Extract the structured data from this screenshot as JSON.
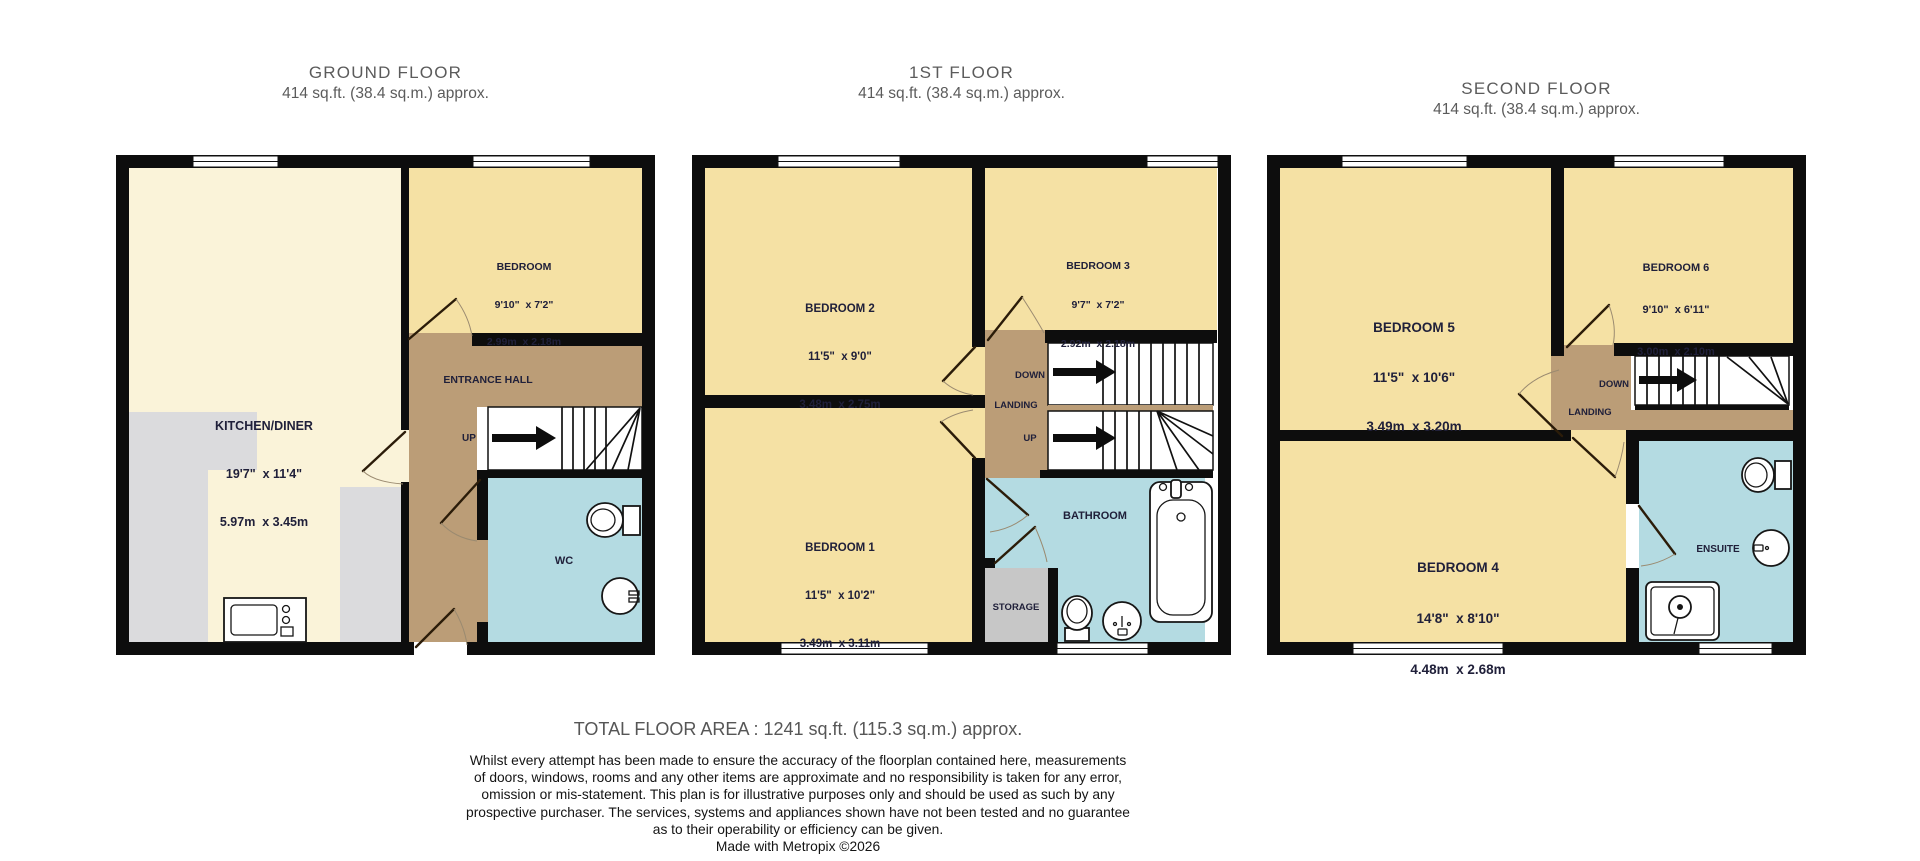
{
  "floors": [
    {
      "title": "GROUND FLOOR",
      "area": "414 sq.ft. (38.4 sq.m.) approx.",
      "rooms": {
        "bedroom": {
          "name": "BEDROOM",
          "imperial": "9'10\"  x 7'2\"",
          "metric": "2.99m  x 2.18m"
        },
        "kitchen": {
          "name": "KITCHEN/DINER",
          "imperial": "19'7\"  x 11'4\"",
          "metric": "5.97m  x 3.45m"
        },
        "hall": {
          "name": "ENTRANCE HALL"
        },
        "wc": {
          "name": "WC"
        },
        "stairs": {
          "up": "UP"
        }
      }
    },
    {
      "title": "1ST FLOOR",
      "area": "414 sq.ft. (38.4 sq.m.) approx.",
      "rooms": {
        "bedroom2": {
          "name": "BEDROOM 2",
          "imperial": "11'5\"  x 9'0\"",
          "metric": "3.48m  x 2.75m"
        },
        "bedroom3": {
          "name": "BEDROOM 3",
          "imperial": "9'7\"  x 7'2\"",
          "metric": "2.92m  x 2.18m"
        },
        "bedroom1": {
          "name": "BEDROOM 1",
          "imperial": "11'5\"  x 10'2\"",
          "metric": "3.49m  x 3.11m"
        },
        "landing": {
          "name": "LANDING",
          "down": "DOWN",
          "up": "UP"
        },
        "bathroom": {
          "name": "BATHROOM"
        },
        "storage": {
          "name": "STORAGE"
        }
      }
    },
    {
      "title": "SECOND FLOOR",
      "area": "414 sq.ft. (38.4 sq.m.) approx.",
      "rooms": {
        "bedroom5": {
          "name": "BEDROOM 5",
          "imperial": "11'5\"  x 10'6\"",
          "metric": "3.49m  x 3.20m"
        },
        "bedroom6": {
          "name": "BEDROOM 6",
          "imperial": "9'10\"  x 6'11\"",
          "metric": "3.00m  x 2.10m"
        },
        "bedroom4": {
          "name": "BEDROOM 4",
          "imperial": "14'8\"  x 8'10\"",
          "metric": "4.48m  x 2.68m"
        },
        "landing": {
          "name": "LANDING",
          "down": "DOWN"
        },
        "ensuite": {
          "name": "ENSUITE"
        }
      }
    }
  ],
  "footer": {
    "total": "TOTAL FLOOR AREA : 1241 sq.ft. (115.3 sq.m.) approx.",
    "disclaimer": [
      "Whilst every attempt has been made to ensure the accuracy of the floorplan contained here, measurements",
      "of doors, windows, rooms and any other items are approximate and no responsibility is taken for any error,",
      "omission or mis-statement. This plan is for illustrative purposes only and should be used as such by any",
      "prospective purchaser. The services, systems and appliances shown have not been tested and no guarantee",
      "as to their operability or efficiency can be given."
    ],
    "credit": "Made with Metropix ©2026"
  },
  "colors": {
    "wall": "#0d0d0d",
    "bedroom_fill": "#f5e1a4",
    "kitchen_fill": "#faf3d9",
    "hall_fill": "#bb9d77",
    "wet_room_fill": "#b4dbe2",
    "counter_fill": "#dbdbdd",
    "storage_fill": "#c7c7c7"
  }
}
